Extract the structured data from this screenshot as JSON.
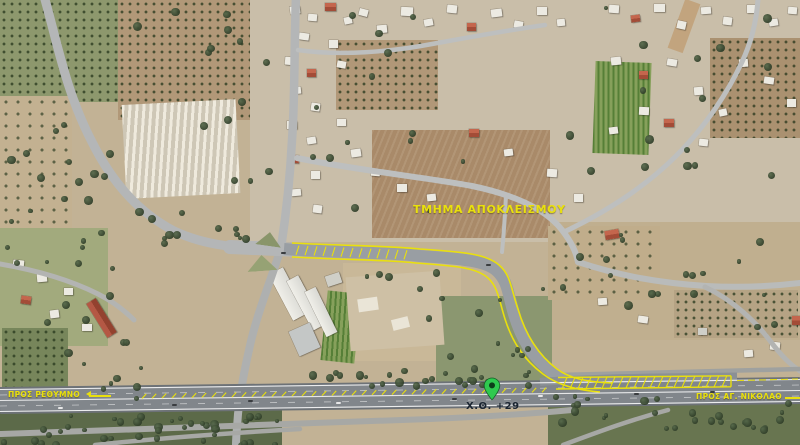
{
  "map": {
    "labels": {
      "closure_section": "ΤΜΗΜΑ ΑΠΟΚΛΕΙΣΜΟΥ",
      "to_rethymno": "ΠΡΟΣ ΡΕΘΥΜΝΟ",
      "to_agios_nikolaos": "ΠΡΟΣ ΑΓ. ΝΙΚΟΛΑΟ",
      "chainage": "Χ.Θ. +29"
    },
    "marker": {
      "type": "map-pin",
      "points_to": "chainage position on highway"
    },
    "colors": {
      "annotation_yellow": "#e9e00d",
      "pin_green": "#2fc94f",
      "pin_dot": "#0c3d1a",
      "chainage_text": "#1a2430"
    }
  }
}
